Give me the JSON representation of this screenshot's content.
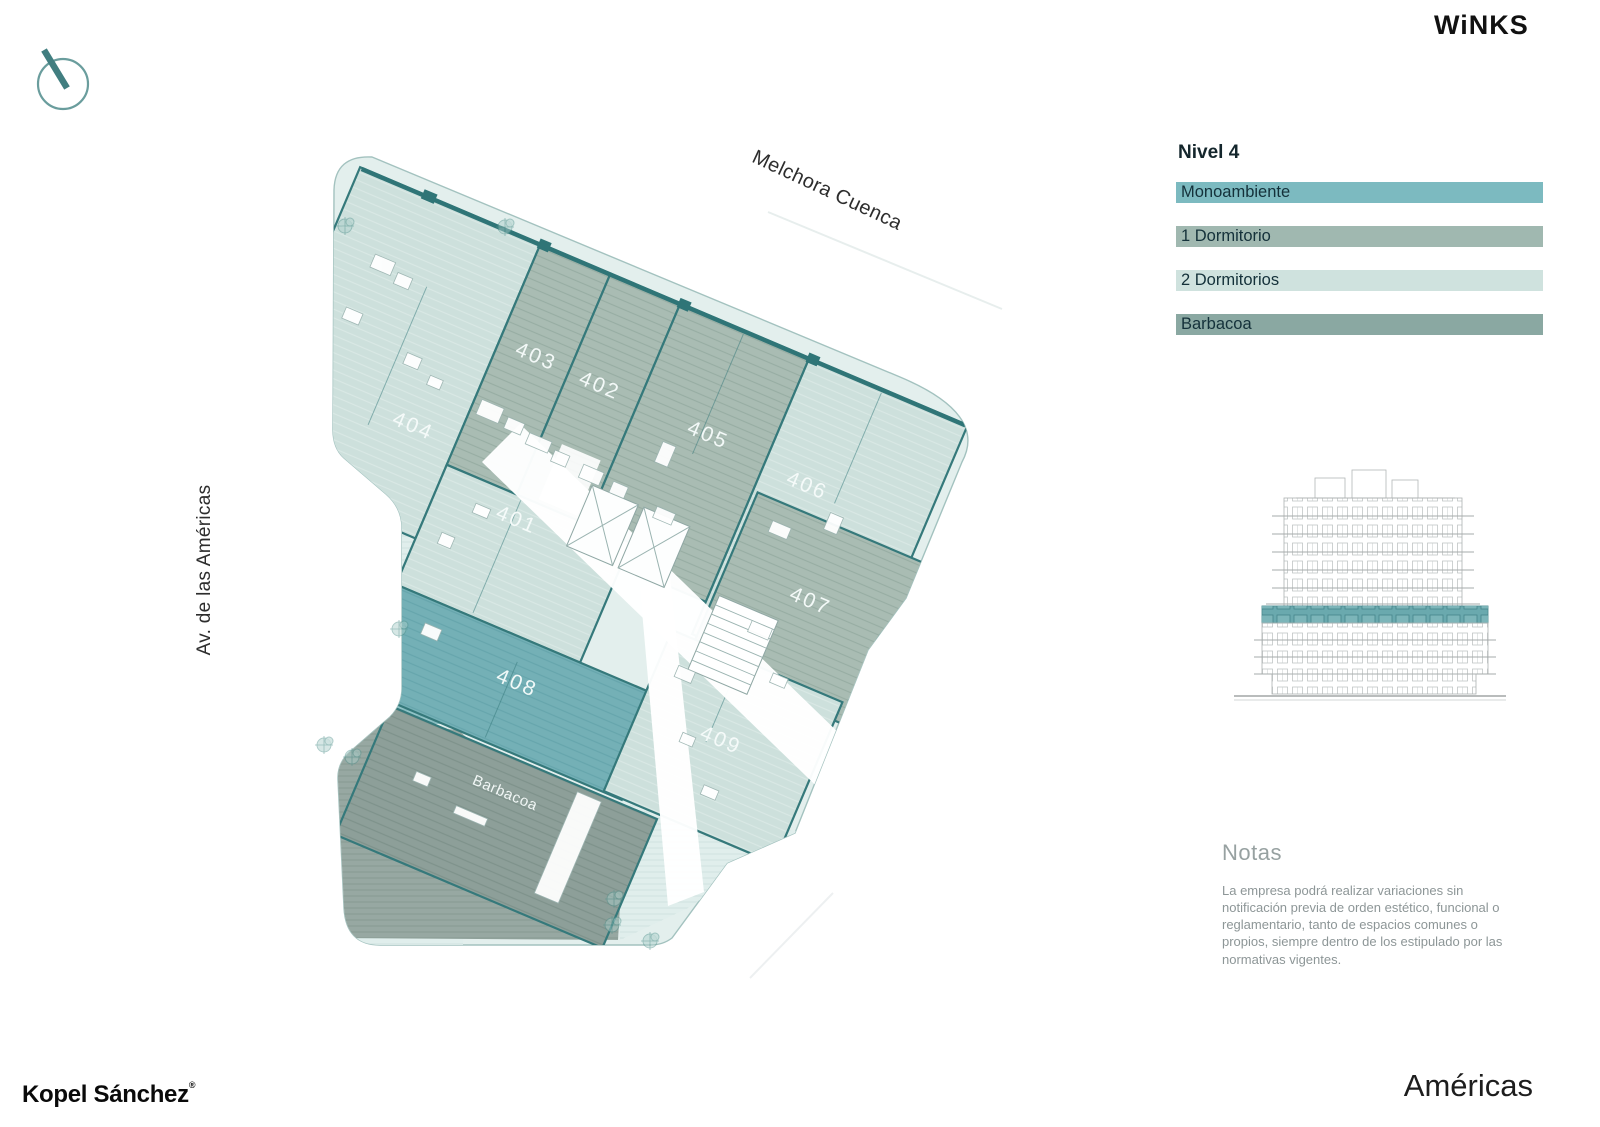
{
  "brand": {
    "logo_text": "WiNKS"
  },
  "footer": {
    "developer": "Kopel Sánchez",
    "registered_mark": "®",
    "project_title": "Américas"
  },
  "streets": {
    "top": "Melchora Cuenca",
    "left": "Av. de las Américas"
  },
  "legend": {
    "title": "Nivel 4",
    "items": [
      {
        "label": "Monoambiente",
        "color": "#7cbac0"
      },
      {
        "label": "1 Dormitorio",
        "color": "#a0b8b0"
      },
      {
        "label": "2 Dormitorios",
        "color": "#cfe2de"
      },
      {
        "label": "Barbacoa",
        "color": "#8aa8a2"
      }
    ]
  },
  "plan": {
    "units": [
      {
        "label": "401",
        "type": "2 Dormitorios"
      },
      {
        "label": "402",
        "type": "1 Dormitorio"
      },
      {
        "label": "403",
        "type": "1 Dormitorio"
      },
      {
        "label": "404",
        "type": "2 Dormitorios"
      },
      {
        "label": "405",
        "type": "1 Dormitorio"
      },
      {
        "label": "406",
        "type": "2 Dormitorios"
      },
      {
        "label": "407",
        "type": "1 Dormitorio"
      },
      {
        "label": "408",
        "type": "Monoambiente"
      },
      {
        "label": "409",
        "type": "2 Dormitorios"
      }
    ],
    "barbacoa_label": "Barbacoa"
  },
  "elevation": {
    "highlight_color": "#6aa9ae"
  },
  "notes": {
    "title": "Notas",
    "body": "La empresa podrá realizar variaciones sin notificación previa de orden estético, funcional o reglamentario, tanto de espacios comunes o propios, siempre dentro de los estipulado por las normativas vigentes."
  }
}
